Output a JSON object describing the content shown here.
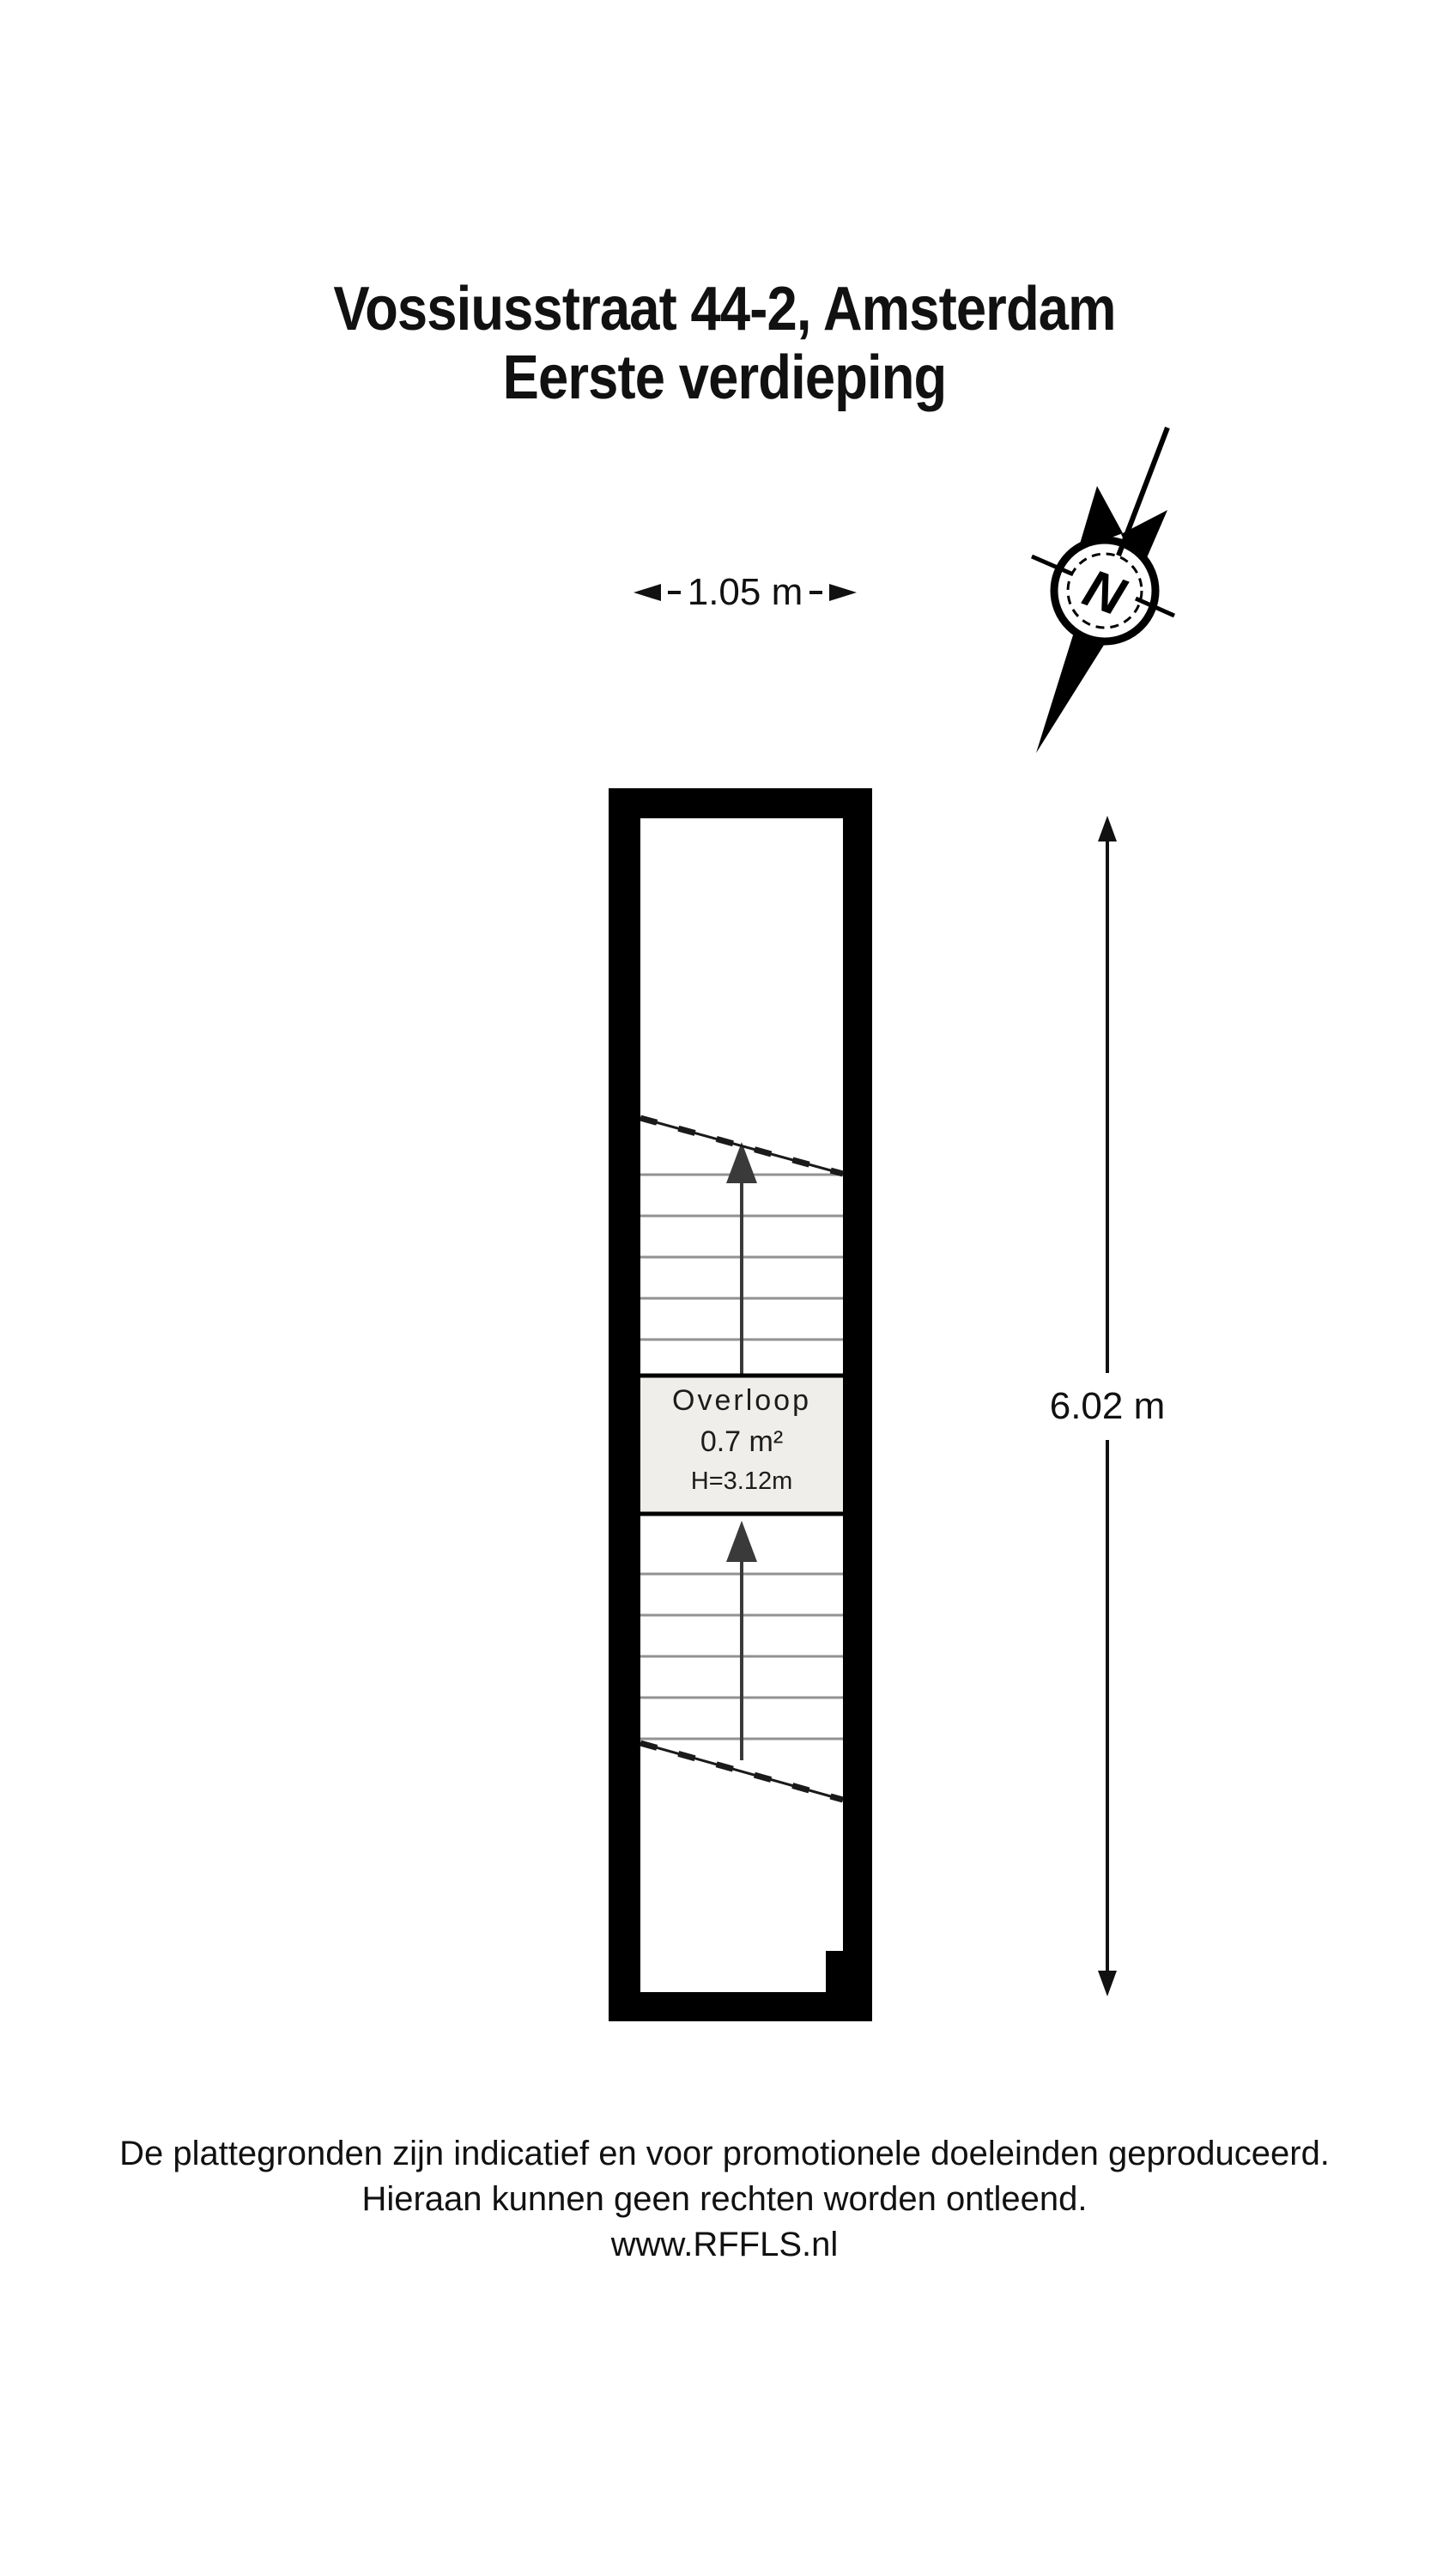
{
  "title": {
    "line1": "Vossiusstraat 44-2, Amsterdam",
    "line2": "Eerste verdieping"
  },
  "compass": {
    "letter": "N"
  },
  "dimensions": {
    "width_label": "1.05 m",
    "height_label": "6.02 m"
  },
  "room": {
    "name": "Overloop",
    "area": "0.7 m²",
    "ceiling_height": "H=3.12m"
  },
  "stairs": {
    "upper_flight_treads": 5,
    "lower_flight_treads": 5,
    "direction_arrows": "up"
  },
  "footer": {
    "line1": "De plattegronden zijn indicatief en voor promotionele doeleinden geproduceerd.",
    "line2": "Hieraan kunnen geen rechten worden ontleend.",
    "line3": "www.RFFLS.nl"
  },
  "colors": {
    "wall": "#000000",
    "tread": "#929292",
    "arrow": "#3a3a3a",
    "landing_fill": "#efeeea",
    "text": "#111111"
  }
}
